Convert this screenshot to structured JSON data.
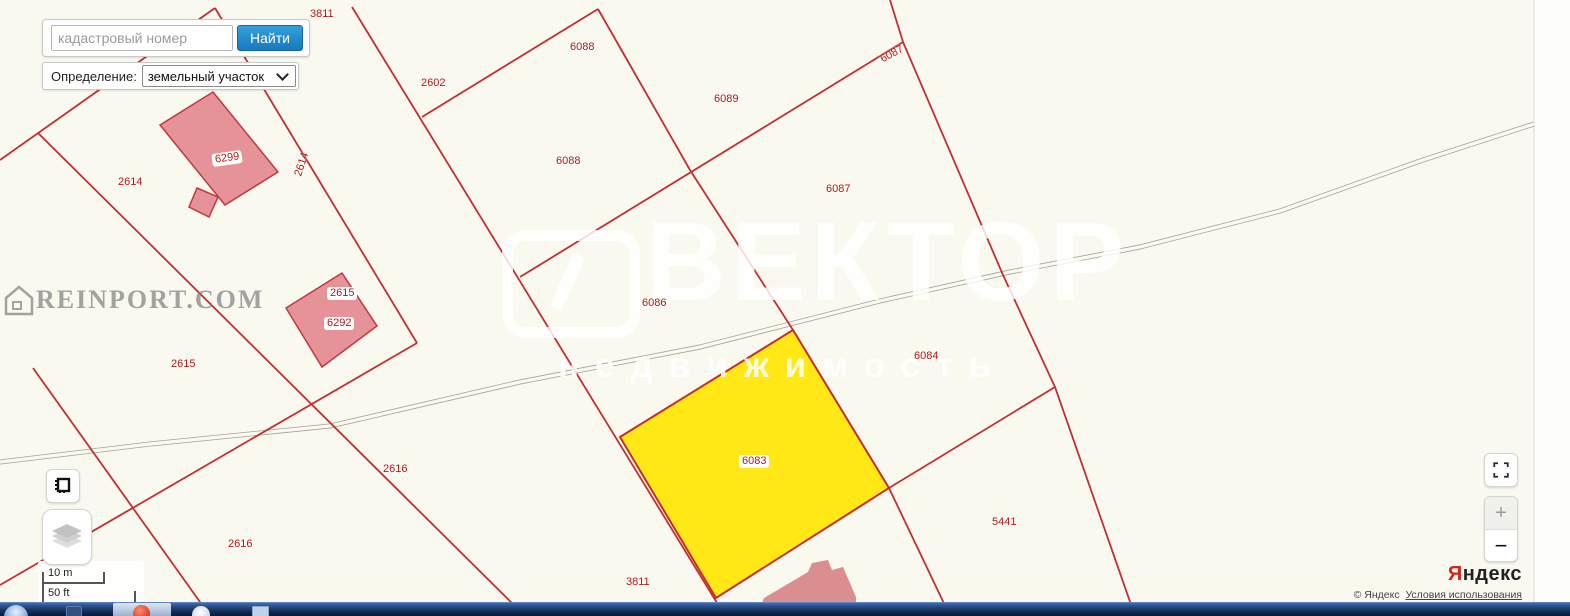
{
  "search": {
    "placeholder": "кадастровый номер",
    "button_label": "Найти"
  },
  "filter": {
    "label": "Определение:",
    "selected_option": "земельный участок"
  },
  "map": {
    "labels": [
      {
        "text": "3811"
      },
      {
        "text": "2614"
      },
      {
        "text": "6088"
      },
      {
        "text": "2602"
      },
      {
        "text": "6089"
      },
      {
        "text": "6087"
      },
      {
        "text": "6088"
      },
      {
        "text": "6087"
      },
      {
        "text": "2614"
      },
      {
        "text": "2614"
      },
      {
        "text": "6299"
      },
      {
        "text": "2615"
      },
      {
        "text": "6292"
      },
      {
        "text": "2615"
      },
      {
        "text": "6086"
      },
      {
        "text": "6084"
      },
      {
        "text": "6083"
      },
      {
        "text": "2616"
      },
      {
        "text": "2616"
      },
      {
        "text": "5441"
      },
      {
        "text": "3811"
      }
    ],
    "highlighted_parcel": "6083",
    "colors": {
      "parcel_line": "#c52e2e",
      "parcel_label": "#b01818",
      "highlight_fill": "#ffe815",
      "building_fill": "#e59399",
      "background": "#faf9ef",
      "accent_blue": "#1679bd"
    }
  },
  "watermarks": {
    "reinport": "REINPORT.COM",
    "vector_title": "ВЕКТОР",
    "vector_subtitle": "недвижимость"
  },
  "scalebar": {
    "metric": "10 m",
    "imperial": "50 ft"
  },
  "controls": {
    "zoom_in": "+",
    "zoom_out": "−"
  },
  "attribution": {
    "brand_first_letter": "Я",
    "brand_rest": "ндекс",
    "copyright": "© Яндекс",
    "terms_link": "Условия использования"
  }
}
